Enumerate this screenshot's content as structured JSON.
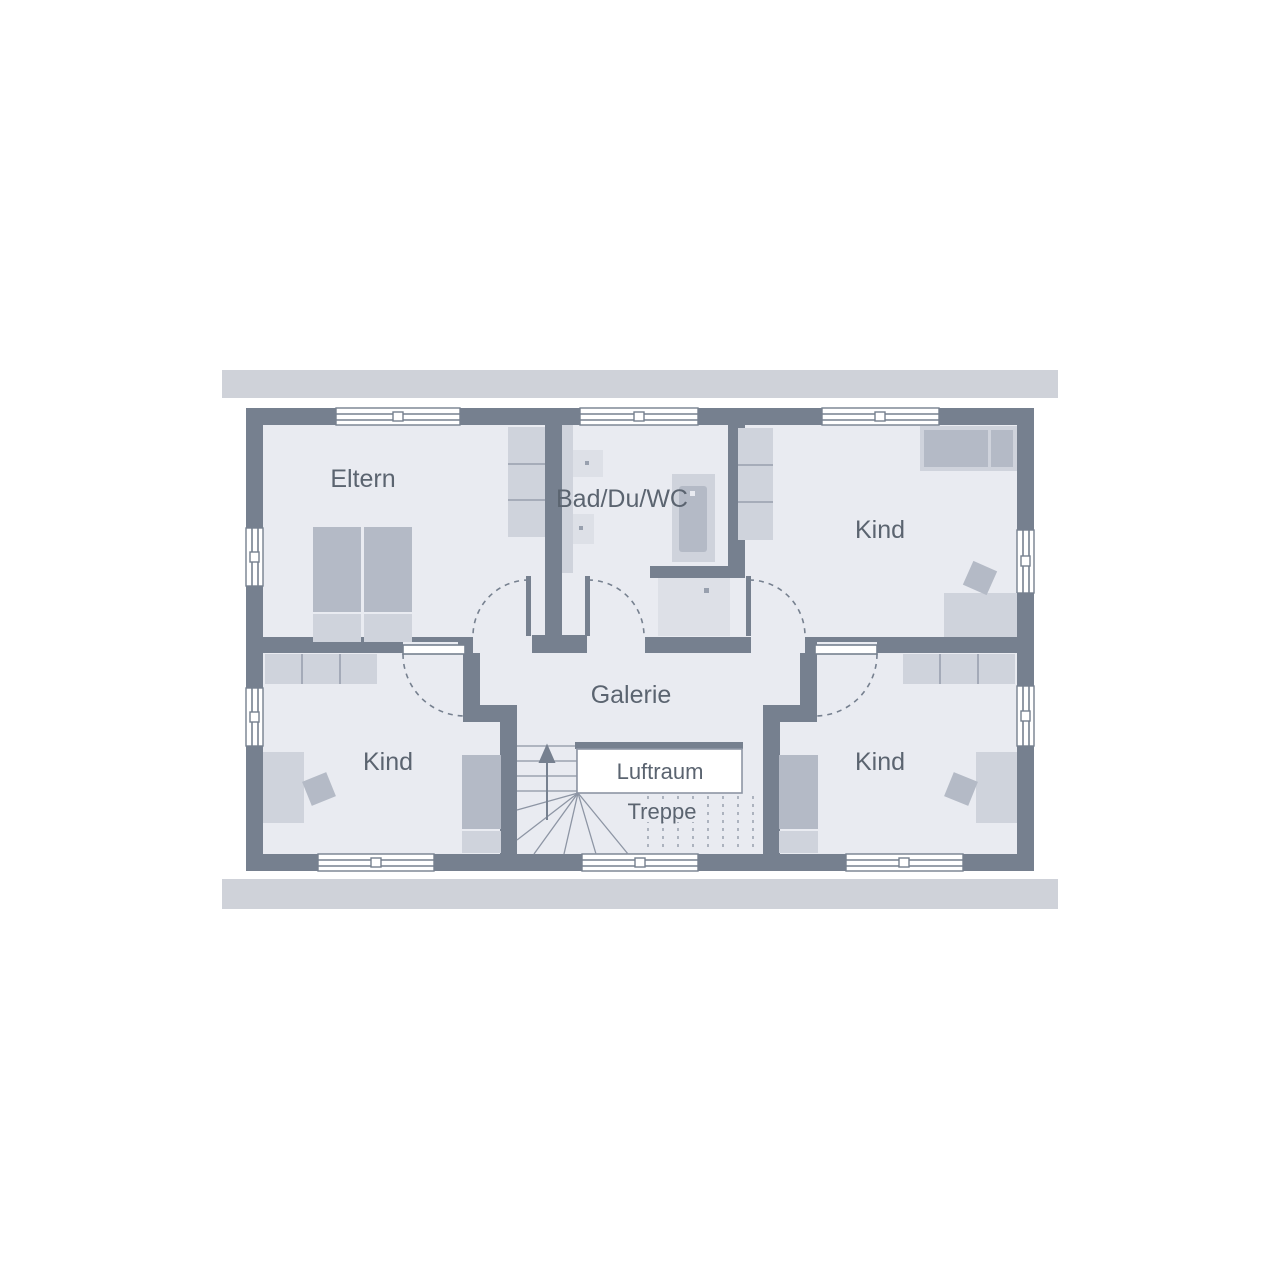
{
  "floorplan": {
    "type": "upper-floor plan",
    "rooms": {
      "eltern": {
        "label": "Eltern"
      },
      "bath": {
        "label": "Bad/Du/WC"
      },
      "kind_top_right": {
        "label": "Kind"
      },
      "kind_bottom_left": {
        "label": "Kind"
      },
      "kind_bottom_right": {
        "label": "Kind"
      },
      "galerie": {
        "label": "Galerie"
      },
      "luftraum": {
        "label": "Luftraum"
      },
      "treppe": {
        "label": "Treppe"
      }
    },
    "colors": {
      "wall": "#76808F",
      "floor": "#E9EBF1",
      "roof-bar": "#CFD2D9",
      "furniture-light": "#CFD3DC",
      "furniture-medium": "#B4BAC6",
      "fixture": "#DDE0E7",
      "tread": "#8D95A4",
      "label-text": "#5B6470",
      "dot": "#98A0AE",
      "white": "#FFFFFF"
    }
  }
}
